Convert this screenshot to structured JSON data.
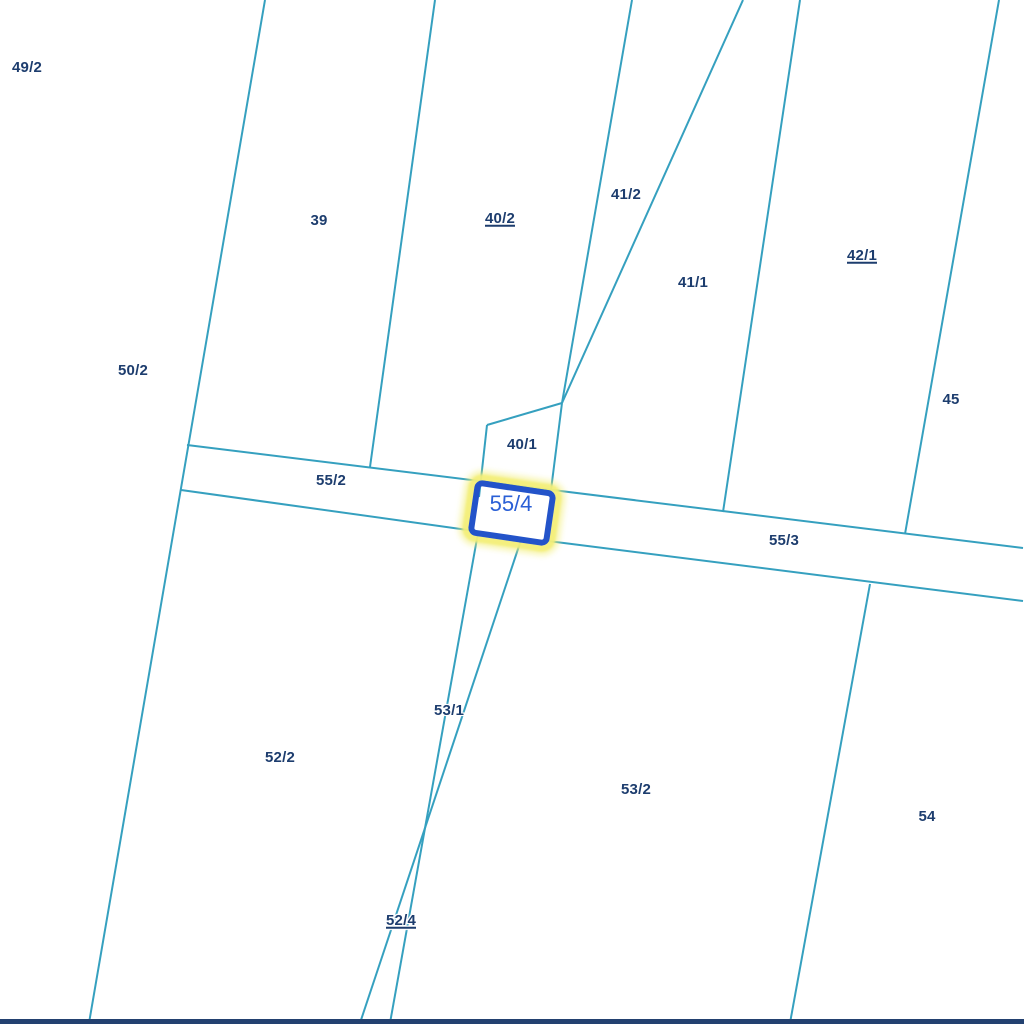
{
  "map": {
    "background_color": "#ffffff",
    "boundary_line_color": "#35a0bf",
    "boundary_line_width": 2,
    "parcel_label_color": "#1d3d6e",
    "bottom_bar_color": "#234170",
    "selected_parcel": {
      "label": "55/4",
      "center_x": 512,
      "center_y": 513,
      "width": 82,
      "height": 56,
      "rotation_deg": 8.4,
      "border_color": "#2353c9",
      "border_width": 6,
      "halo_color_solid": "rgba(243,238,120,0.9)",
      "halo_color_soft": "rgba(243,238,120,0.55)",
      "label_color": "#2a5fd6",
      "label_x": 511,
      "label_y": 504
    },
    "parcels": [
      {
        "label": "49/2",
        "x": 27,
        "y": 68,
        "underline": false
      },
      {
        "label": "39",
        "x": 319,
        "y": 221,
        "underline": false
      },
      {
        "label": "40/2",
        "x": 500,
        "y": 219,
        "underline": true
      },
      {
        "label": "41/2",
        "x": 626,
        "y": 195,
        "underline": false
      },
      {
        "label": "41/1",
        "x": 693,
        "y": 283,
        "underline": false
      },
      {
        "label": "42/1",
        "x": 862,
        "y": 256,
        "underline": true
      },
      {
        "label": "45",
        "x": 951,
        "y": 400,
        "underline": false
      },
      {
        "label": "50/2",
        "x": 133,
        "y": 371,
        "underline": false
      },
      {
        "label": "40/1",
        "x": 522,
        "y": 445,
        "underline": false
      },
      {
        "label": "55/2",
        "x": 331,
        "y": 481,
        "underline": false
      },
      {
        "label": "55/3",
        "x": 784,
        "y": 541,
        "underline": false
      },
      {
        "label": "53/1",
        "x": 449,
        "y": 711,
        "underline": false
      },
      {
        "label": "52/2",
        "x": 280,
        "y": 758,
        "underline": false
      },
      {
        "label": "53/2",
        "x": 636,
        "y": 790,
        "underline": false
      },
      {
        "label": "54",
        "x": 927,
        "y": 817,
        "underline": false
      },
      {
        "label": "52/4",
        "x": 401,
        "y": 921,
        "underline": true
      }
    ],
    "boundary_lines": [
      [
        265,
        0,
        89,
        1023
      ],
      [
        435,
        0,
        370,
        467
      ],
      [
        632,
        0,
        562,
        403
      ],
      [
        743,
        0,
        562,
        403
      ],
      [
        800,
        0,
        723,
        512
      ],
      [
        999,
        0,
        905,
        534
      ],
      [
        187,
        445,
        1023,
        548
      ],
      [
        181,
        490,
        475,
        531
      ],
      [
        548,
        541,
        1023,
        601
      ],
      [
        478,
        533,
        390,
        1023
      ],
      [
        521,
        540,
        360,
        1023
      ],
      [
        870,
        584,
        790,
        1023
      ],
      [
        562,
        403,
        487,
        425
      ],
      [
        487,
        425,
        479,
        497
      ],
      [
        562,
        403,
        551,
        490
      ]
    ]
  }
}
